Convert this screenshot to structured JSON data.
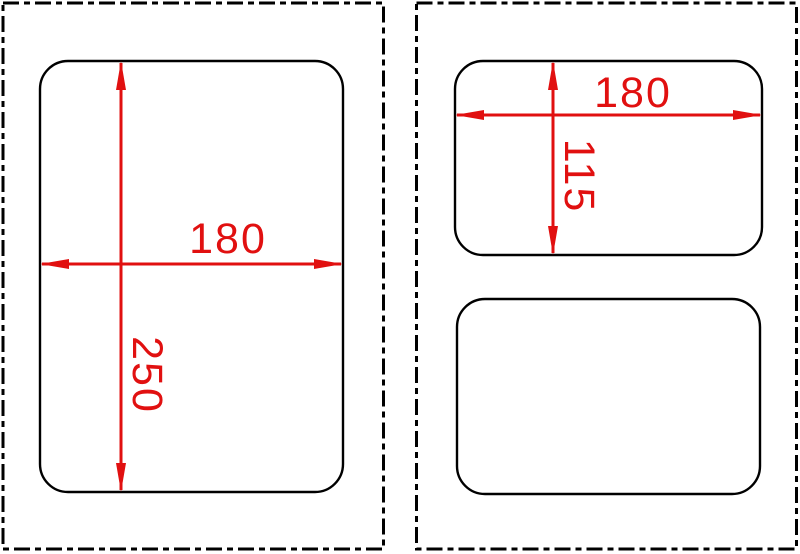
{
  "drawing": {
    "background_color": "#ffffff",
    "outline_color": "#000000",
    "dimension_color": "#e11010",
    "panels": [
      {
        "id": "left",
        "border_style": "dash-dot",
        "shape_count": 1,
        "dimensions": [
          {
            "axis": "horizontal",
            "value": "180"
          },
          {
            "axis": "vertical",
            "value": "250"
          }
        ]
      },
      {
        "id": "right",
        "border_style": "dash-dot",
        "shape_count": 2,
        "dimensions": [
          {
            "axis": "horizontal",
            "value": "180"
          },
          {
            "axis": "vertical",
            "value": "115"
          }
        ]
      }
    ]
  }
}
